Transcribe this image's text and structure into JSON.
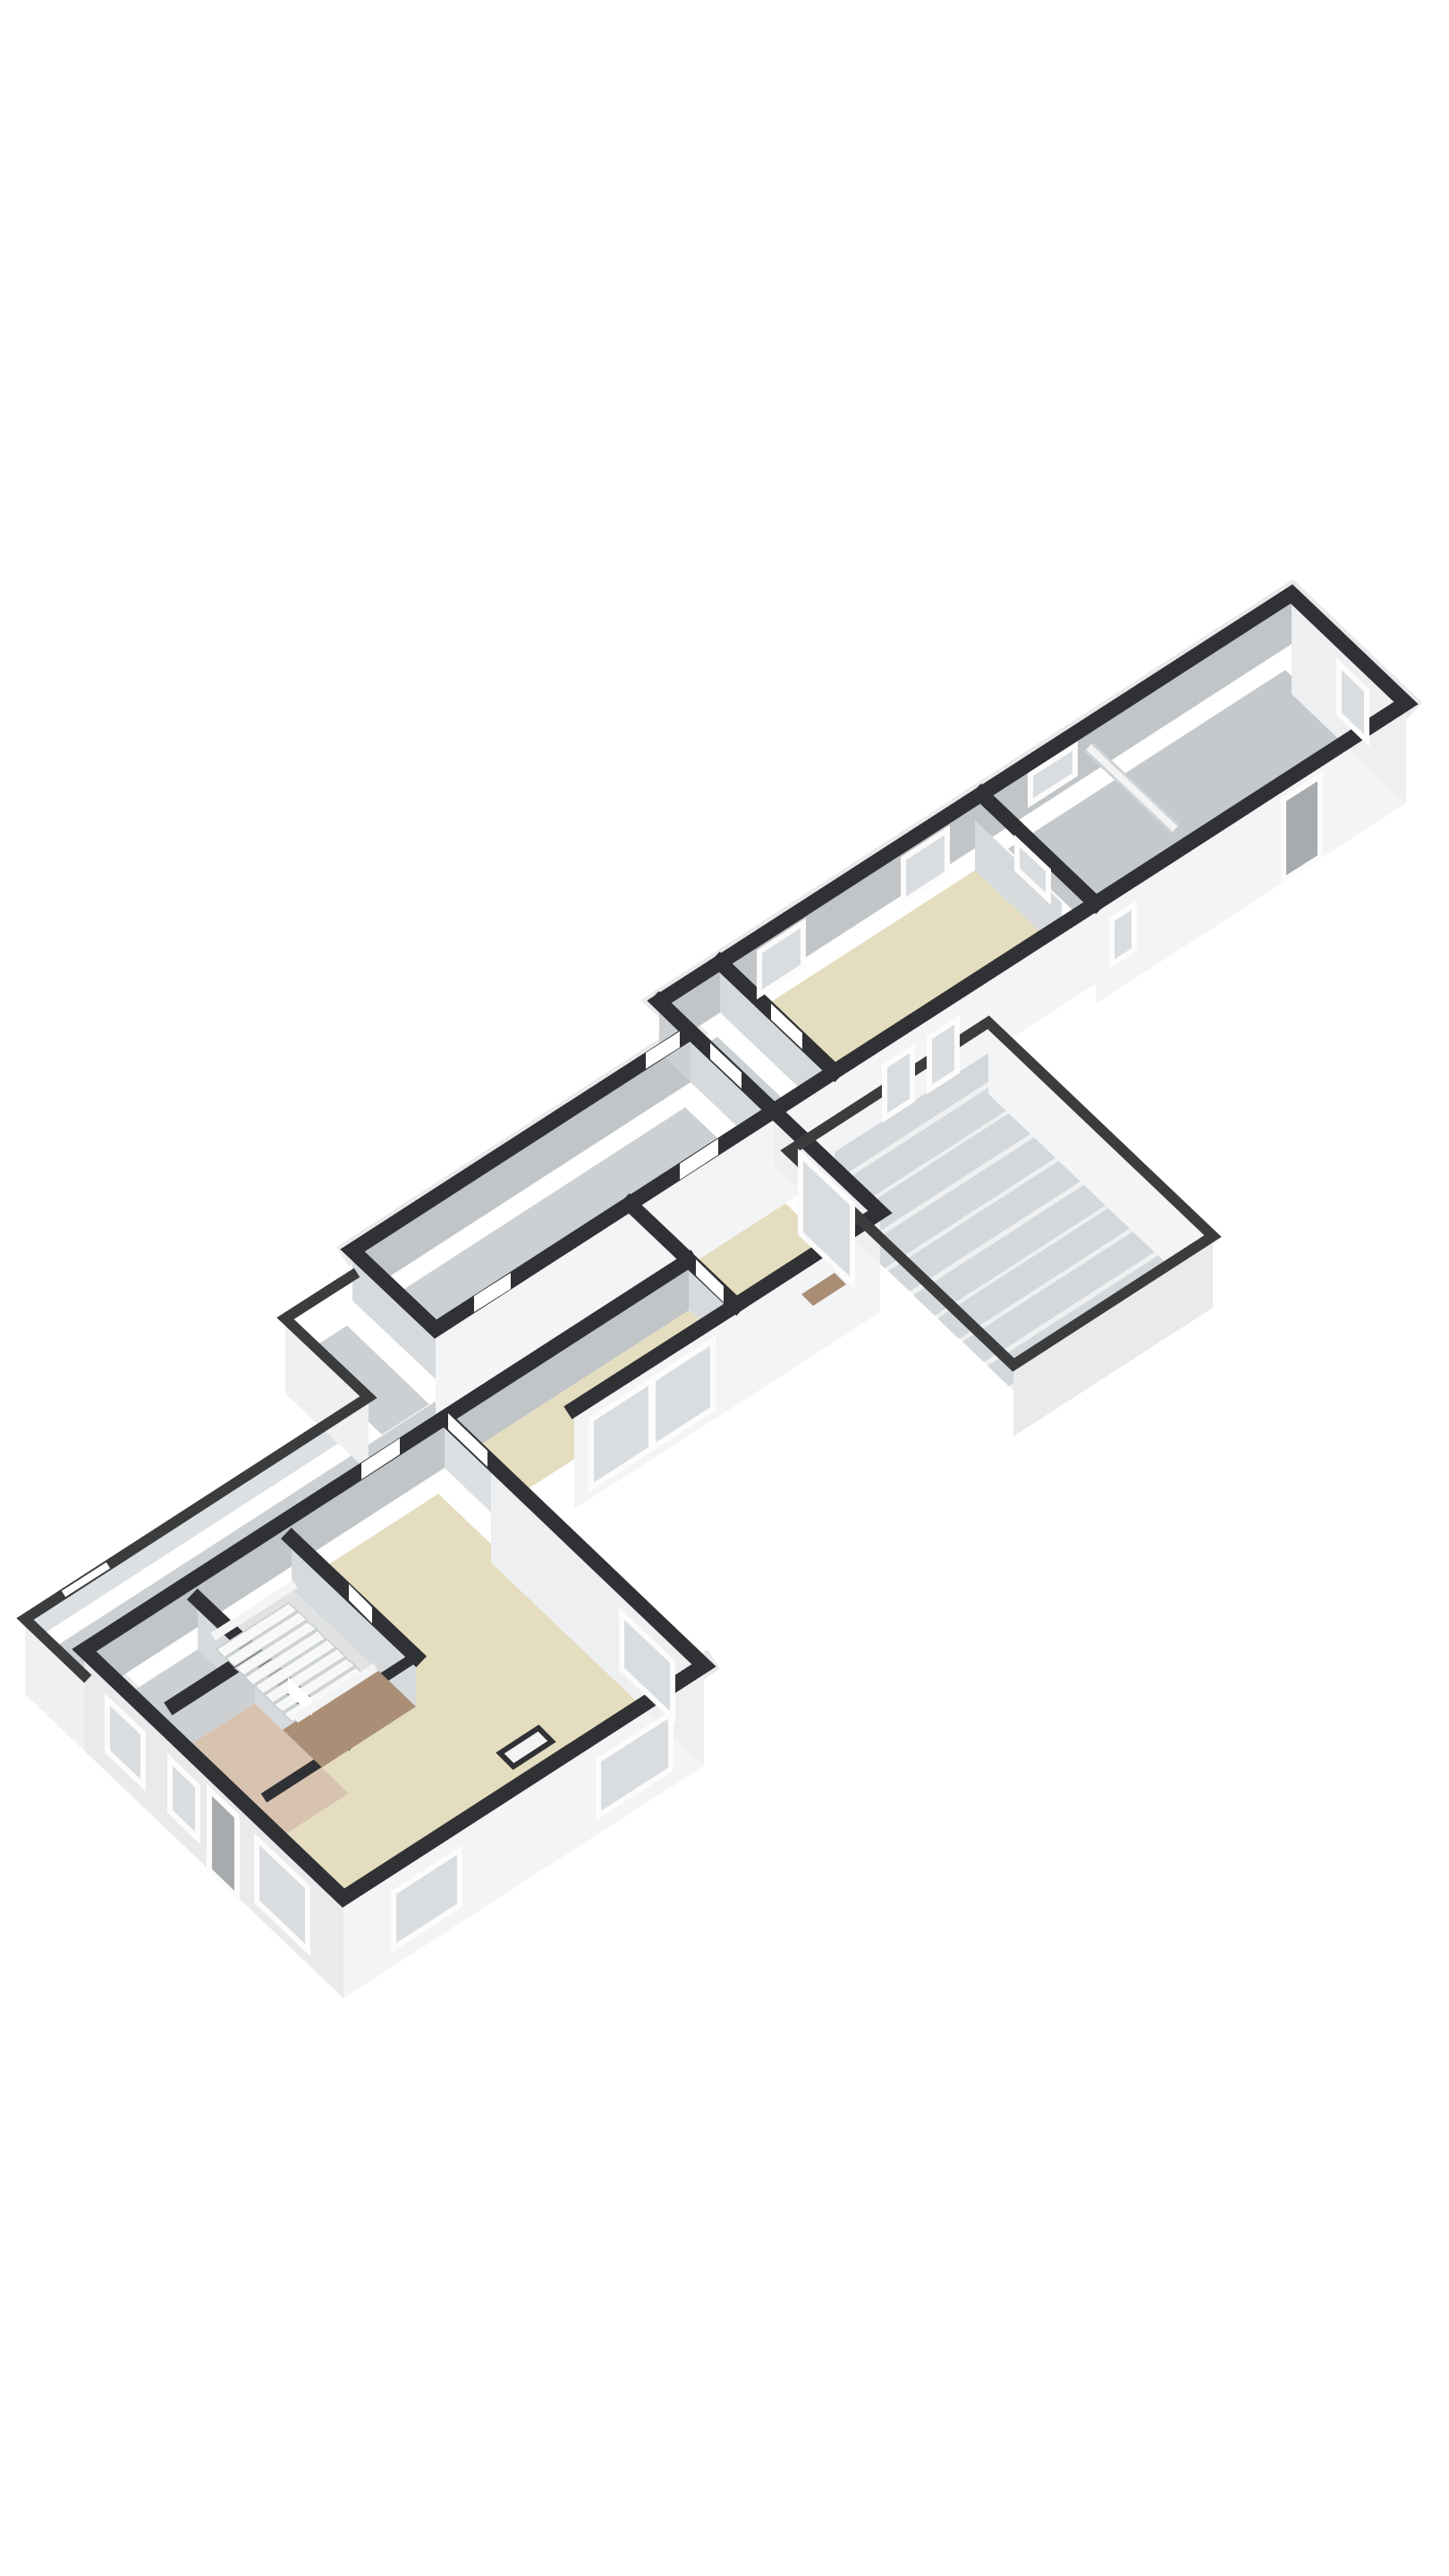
{
  "scene": {
    "kind": "3d-floorplan",
    "view": "axonometric",
    "floor_label": "",
    "visible_text": "none"
  },
  "colors": {
    "background": "#ffffff",
    "cap": "#303134",
    "cap_low": "#3a3c3e",
    "rim": "#e8eaeb",
    "floor_beige": "#e5ddbf",
    "floor_gray": "#ccd0d2",
    "floor_gray_dark": "#c5c9cc",
    "floor_tan": "#d8c2b0",
    "floor_brown": "#aa8f76",
    "stair_floor": "#e0e2e4",
    "face_north": "#c1c5c7",
    "face_side": "#d7dadc",
    "face_inner": "#cdd0d2",
    "face_light": "#dde0e2",
    "ext_south": "#f3f4f6",
    "ext_west": "#e8eaec",
    "ext_east": "#edeff1",
    "ext_low": "#eef0f1",
    "deck_base": "#eef0f1",
    "deck_plank": "#d5d8da",
    "tread": "#f7f8f9",
    "tread_edge": "#c9cccd",
    "stringer": "#f3f4f5",
    "window_frame": "#fcfcfd",
    "glass": "#dadde0",
    "door_dark": "#a7abad",
    "opening": "#ffffff",
    "threshold": "#a98e74",
    "divider": "#f2f3f4",
    "divider_edge": "#d0d3d5",
    "chimney": "#f2f3f4"
  },
  "rooms": [
    {
      "id": "barn",
      "label": "far long room",
      "floor": "gray"
    },
    {
      "id": "workroom",
      "label": "long beige room",
      "floor": "beige"
    },
    {
      "id": "vestibule",
      "label": "vestibule",
      "floor": "gray"
    },
    {
      "id": "corridor",
      "label": "corridor",
      "floor": "gray"
    },
    {
      "id": "porch",
      "label": "porch",
      "floor": "gray"
    },
    {
      "id": "patio",
      "label": "back patio",
      "floor": "gray"
    },
    {
      "id": "garden-room",
      "label": "garden room",
      "floor": "beige"
    },
    {
      "id": "living-room",
      "label": "living room",
      "floor": "beige"
    },
    {
      "id": "back-room",
      "label": "back room",
      "floor": "gray"
    },
    {
      "id": "hallway",
      "label": "hallway",
      "floor": "tan"
    },
    {
      "id": "stairs",
      "label": "staircase",
      "floor": "white treads, brown landing"
    },
    {
      "id": "terrace",
      "label": "deck terrace",
      "floor": "planks"
    }
  ],
  "features": {
    "stair_treads": 8,
    "deck_planks": 9,
    "windows_total": 16,
    "door_openings": 10
  }
}
